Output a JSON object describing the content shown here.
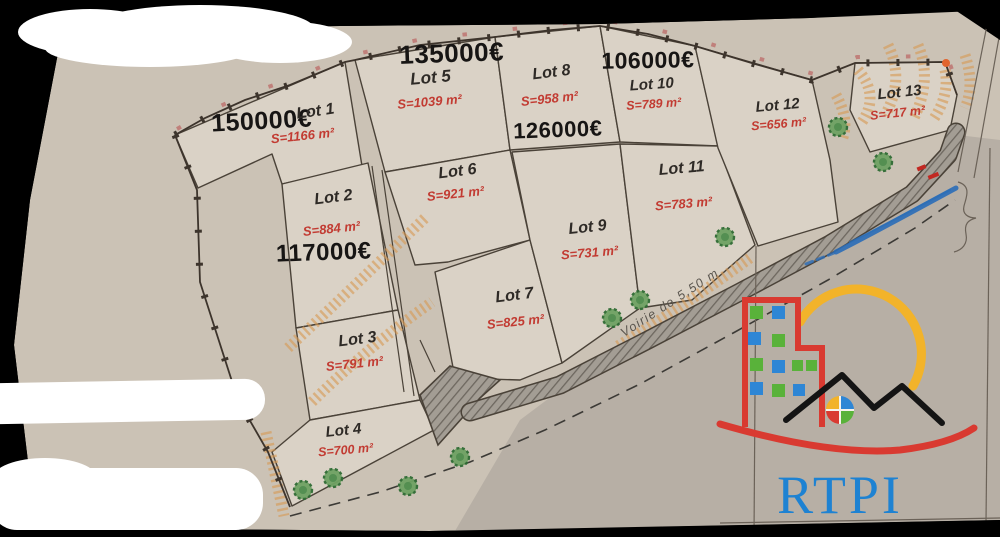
{
  "plan": {
    "road_label": "Voirie de 5,50 m",
    "lots": [
      {
        "name": "Lot 1",
        "area": "S=1166 m²",
        "price": "150000€"
      },
      {
        "name": "Lot 2",
        "area": "S=884 m²",
        "price": "117000€"
      },
      {
        "name": "Lot 3",
        "area": "S=791 m²"
      },
      {
        "name": "Lot 4",
        "area": "S=700 m²"
      },
      {
        "name": "Lot 5",
        "area": "S=1039 m²",
        "price": "135000€"
      },
      {
        "name": "Lot 6",
        "area": "S=921 m²"
      },
      {
        "name": "Lot 7",
        "area": "S=825 m²"
      },
      {
        "name": "Lot 8",
        "area": "S=958 m²",
        "price": "126000€"
      },
      {
        "name": "Lot 9",
        "area": "S=731 m²"
      },
      {
        "name": "Lot 10",
        "area": "S=789 m²",
        "price": "106000€"
      },
      {
        "name": "Lot 11",
        "area": "S=783 m²"
      },
      {
        "name": "Lot 12",
        "area": "S=656 m²"
      },
      {
        "name": "Lot 13",
        "area": "S=717 m²"
      }
    ]
  },
  "logo": {
    "wordmark": "RTPI"
  },
  "colors": {
    "paper": "#cbc2b5",
    "lot_fill": "#dad2c6",
    "area_red": "#c23b32",
    "logo_red": "#d93a31",
    "logo_blue": "#1e82d2",
    "logo_yellow": "#f2b32a",
    "logo_green": "#59b23a",
    "stream_blue": "#2a6db8",
    "talus_orange": "#d79a55"
  }
}
